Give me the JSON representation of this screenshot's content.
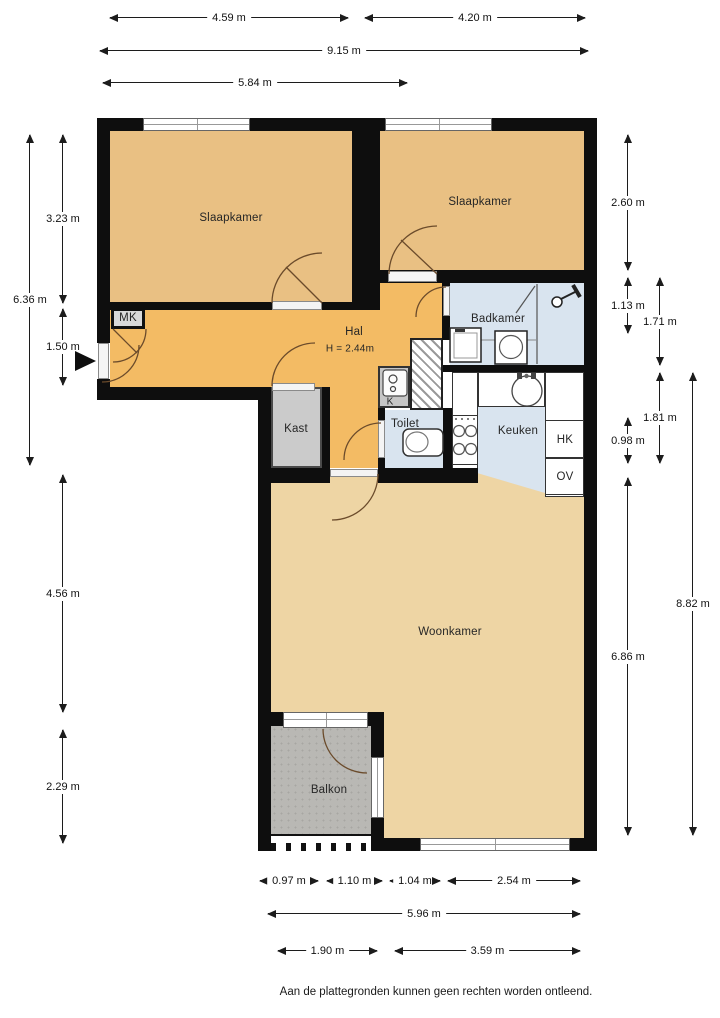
{
  "footer": {
    "disclaimer": "Aan de plattegronden kunnen geen rechten worden ontleend."
  },
  "rooms": {
    "slaapkamer_left": {
      "label": "Slaapkamer"
    },
    "slaapkamer_right": {
      "label": "Slaapkamer"
    },
    "hal": {
      "label": "Hal",
      "ceiling_height": "H = 2.44m"
    },
    "badkamer": {
      "label": "Badkamer"
    },
    "keuken": {
      "label": "Keuken"
    },
    "toilet": {
      "label": "Toilet"
    },
    "kast": {
      "label": "Kast"
    },
    "woonkamer": {
      "label": "Woonkamer"
    },
    "balkon": {
      "label": "Balkon"
    },
    "mk": {
      "label": "MK"
    },
    "k": {
      "label": "K"
    },
    "hk": {
      "label": "HK"
    },
    "ov": {
      "label": "OV"
    }
  },
  "dimensions": {
    "top": [
      {
        "label": "4.59 m"
      },
      {
        "label": "4.20 m"
      },
      {
        "label": "9.15 m"
      },
      {
        "label": "5.84 m"
      }
    ],
    "left": [
      {
        "label": "3.23 m"
      },
      {
        "label": "6.36 m"
      },
      {
        "label": "1.50 m"
      },
      {
        "label": "4.56 m"
      },
      {
        "label": "2.29 m"
      }
    ],
    "right": [
      {
        "label": "2.60 m"
      },
      {
        "label": "1.13 m"
      },
      {
        "label": "1.71 m"
      },
      {
        "label": "1.81 m"
      },
      {
        "label": "0.98 m"
      },
      {
        "label": "6.86 m"
      },
      {
        "label": "8.82 m"
      }
    ],
    "bottom": [
      {
        "label": "0.97 m"
      },
      {
        "label": "1.10 m"
      },
      {
        "label": "1.04 m"
      },
      {
        "label": "2.54 m"
      },
      {
        "label": "5.96 m"
      },
      {
        "label": "1.90 m"
      },
      {
        "label": "3.59 m"
      }
    ]
  },
  "colors": {
    "wall": "#0e0e0e",
    "bedroom_floor": "#e9c083",
    "hall_floor": "#f3bb64",
    "wet_room_floor": "#d9e4ef",
    "living_floor": "#eed5a4",
    "balcony_floor": "#b9b8b4",
    "closet_fill": "#cbcbcb",
    "door_swing": "#6b4b2b"
  }
}
